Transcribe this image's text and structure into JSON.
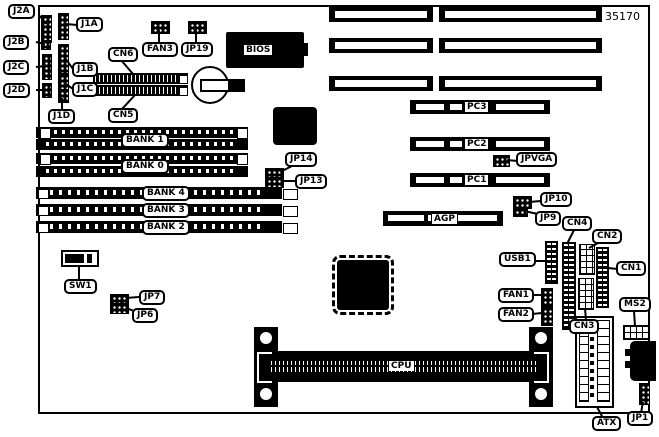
{
  "part_number": "35170",
  "labels": {
    "j2a": "J2A",
    "j2b": "J2B",
    "j2c": "J2C",
    "j2d": "J2D",
    "j1a": "J1A",
    "j1b": "J1B",
    "j1c": "J1C",
    "j1d": "J1D",
    "cn6": "CN6",
    "cn5": "CN5",
    "fan3": "FAN3",
    "jp19": "JP19",
    "bios": "BIOS",
    "pc3": "PC3",
    "pc2": "PC2",
    "pc1": "PC1",
    "jpvga": "JPVGA",
    "agp": "AGP",
    "jp10": "JP10",
    "jp9": "JP9",
    "bank1": "BANK 1",
    "bank0": "BANK 0",
    "bank4": "BANK 4",
    "bank3": "BANK 3",
    "bank2": "BANK 2",
    "jp14": "JP14",
    "jp13": "JP13",
    "sw1": "SW1",
    "jp7": "JP7",
    "jp6": "JP6",
    "usb1": "USB1",
    "cn4": "CN4",
    "cn2": "CN2",
    "cn1": "CN1",
    "fan1": "FAN1",
    "fan2": "FAN2",
    "cn3": "CN3",
    "ms2": "MS2",
    "cpu": "CPU",
    "atx": "ATX",
    "jp1": "JP1"
  },
  "colors": {
    "line": "#000000",
    "background": "#ffffff"
  }
}
